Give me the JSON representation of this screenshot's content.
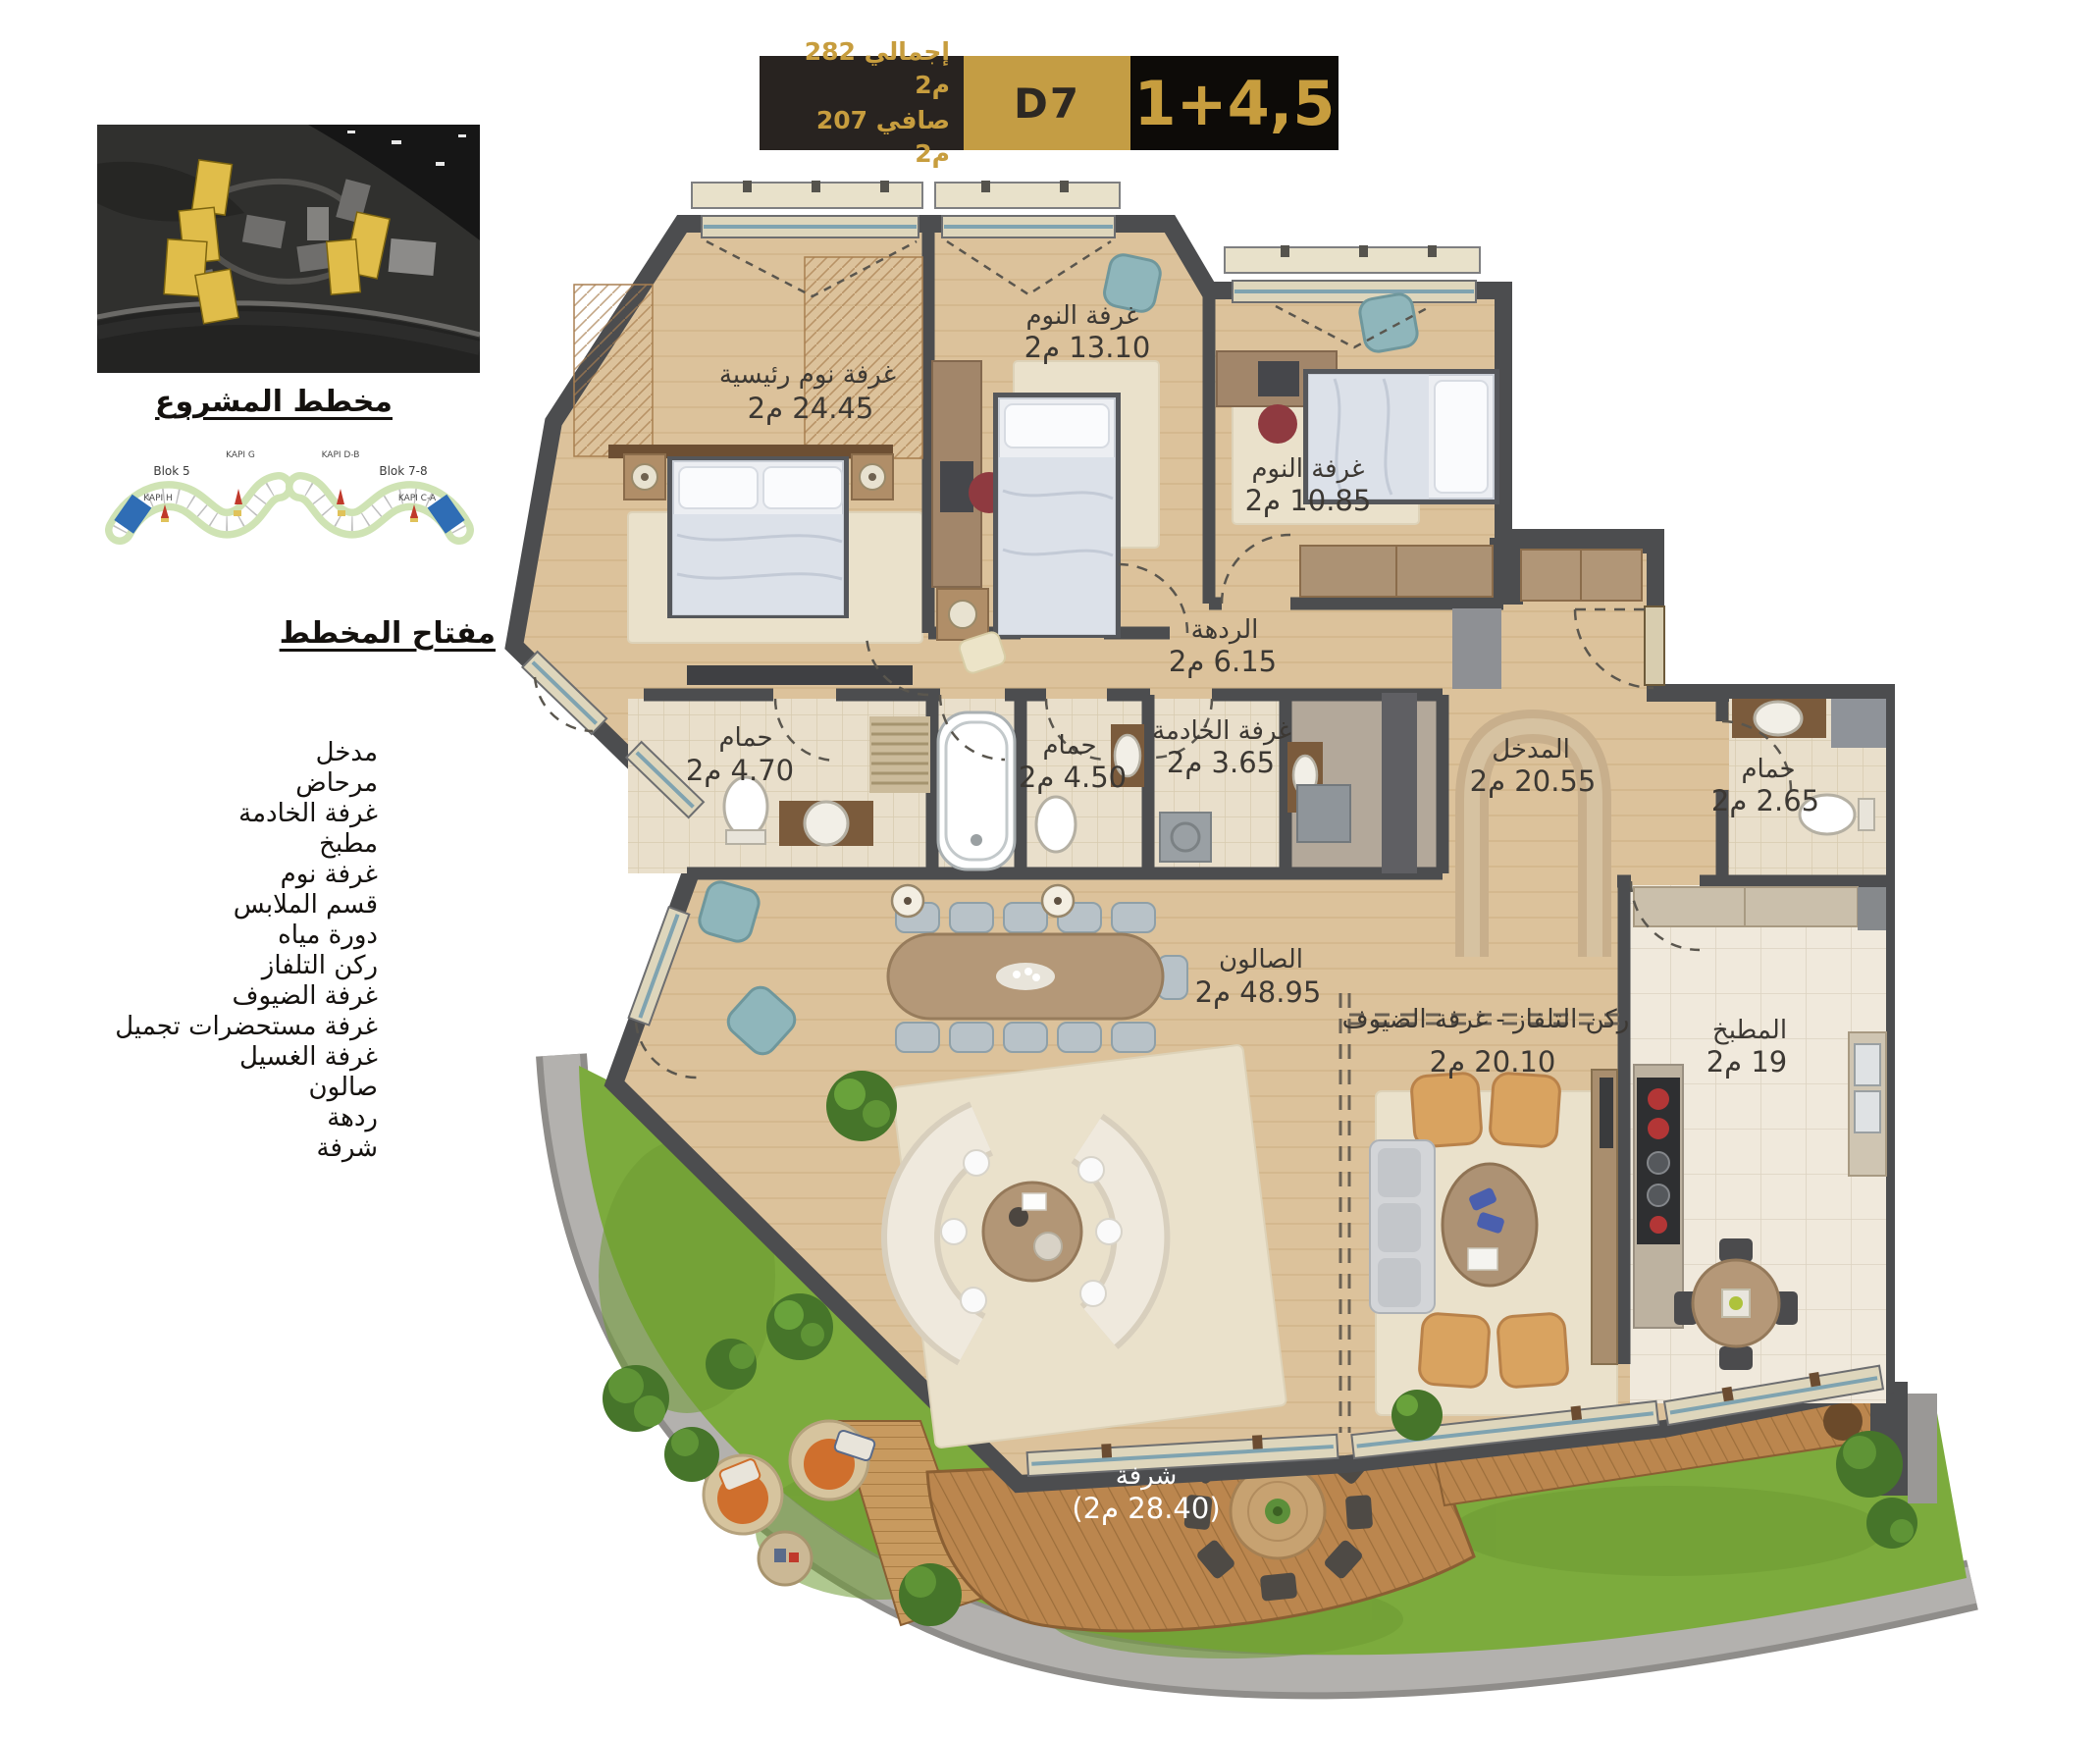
{
  "header": {
    "total_area": "إجمالي 282 م2",
    "net_area": "صافي 207 م2",
    "unit_code": "D7",
    "room_config": "1+4,5"
  },
  "project": {
    "caption": "مخطط المشروع",
    "key_caption": "مفتاح المخطط",
    "site_plans": [
      {
        "block_label": "Blok 5",
        "gate_top": "KAPI G",
        "gate_mid": "KAPI H"
      },
      {
        "block_label": "Blok 7-8",
        "gate_top": "KAPI D-B",
        "gate_mid": "KAPI C-A"
      }
    ]
  },
  "legend": {
    "items": [
      "مدخل",
      "مرحاض",
      "غرفة الخادمة",
      "مطبخ",
      "غرفة نوم",
      "قسم الملابس",
      "دورة مياه",
      "ركن التلفاز",
      "غرفة الضيوف",
      "غرفة مستحضرات تجميل",
      "غرفة الغسيل",
      "صالون",
      "ردهة",
      "شرفة"
    ]
  },
  "rooms": {
    "master_bedroom": {
      "name": "غرفة نوم رئيسية",
      "area": "24.45 م2"
    },
    "bedroom_2": {
      "name": "غرفة النوم",
      "area": "13.10 م2"
    },
    "bedroom_3": {
      "name": "غرفة النوم",
      "area": "10.85 م2"
    },
    "hallway": {
      "name": "الردهة",
      "area": "6.15 م2"
    },
    "bathroom_1": {
      "name": "حمام",
      "area": "4.70 م2"
    },
    "bathroom_2": {
      "name": "حمام",
      "area": "4.50 م2"
    },
    "maid_room": {
      "name": "غرفة الخادمة",
      "area": "3.65 م2"
    },
    "entrance": {
      "name": "المدخل",
      "area": "20.55 م2"
    },
    "bathroom_3": {
      "name": "حمام",
      "area": "2.65 م2"
    },
    "kitchen": {
      "name": "المطبخ",
      "area": "19 م2"
    },
    "salon": {
      "name": "الصالون",
      "area": "48.95 م2"
    },
    "tv_guest": {
      "name": "ركن التلفاز - غرفة الضيوف",
      "area": "20.10 م2"
    },
    "balcony": {
      "name": "شرفة",
      "area": "(28.40 م2)"
    }
  },
  "colors": {
    "accent_gold": "#c49d44",
    "header_dark": "#282320",
    "wall": "#4c4d4f",
    "floor_wood": "#dcc29b",
    "tile": "#e9dfcb",
    "grass": "#7cab3d",
    "deck": "#bb864e",
    "unit_highlight_blue": "#2f6db5",
    "tower_highlight_yellow": "#e0bd4a"
  }
}
